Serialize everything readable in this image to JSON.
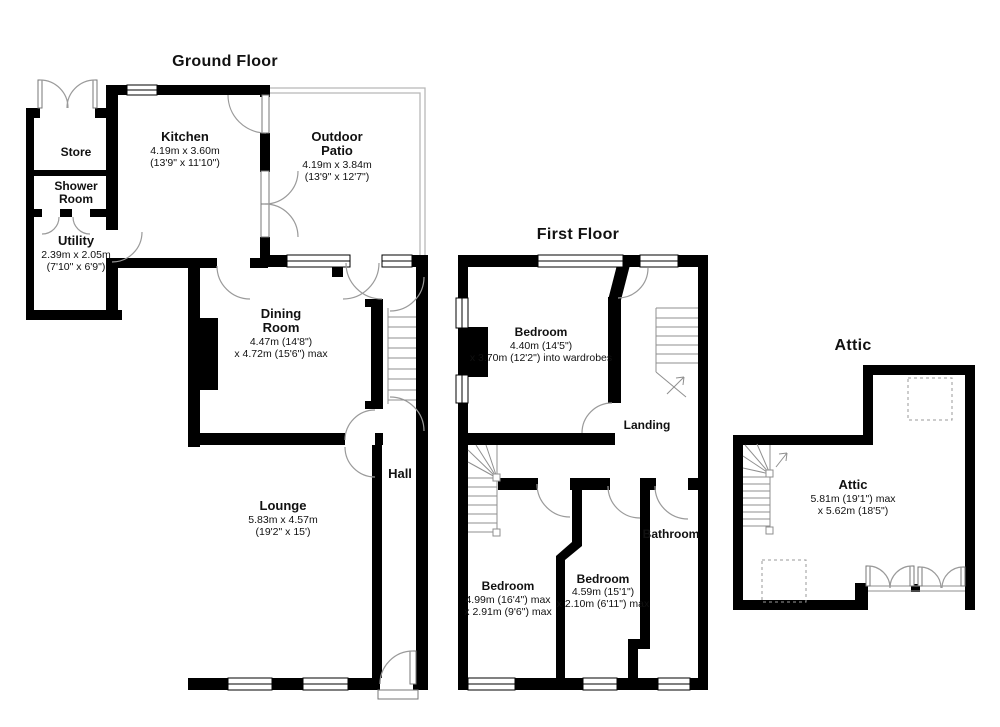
{
  "colors": {
    "background": "#ffffff",
    "wall": "#000000",
    "door_arc": "#9a9a9a",
    "patio_outline": "#b8b8b8",
    "text": "#111111"
  },
  "floors": {
    "ground": {
      "title": "Ground Floor",
      "rooms": {
        "store": {
          "name": "Store"
        },
        "shower_room": {
          "name_line1": "Shower",
          "name_line2": "Room"
        },
        "utility": {
          "name": "Utility",
          "dims_metric": "2.39m x 2.05m",
          "dims_imperial": "(7'10\" x 6'9\")"
        },
        "kitchen": {
          "name": "Kitchen",
          "dims_metric": "4.19m x 3.60m",
          "dims_imperial": "(13'9\" x 11'10\")"
        },
        "outdoor_patio": {
          "name_line1": "Outdoor",
          "name_line2": "Patio",
          "dims_metric": "4.19m x 3.84m",
          "dims_imperial": "(13'9\" x 12'7\")"
        },
        "dining_room": {
          "name_line1": "Dining",
          "name_line2": "Room",
          "dims_line1": "4.47m (14'8\")",
          "dims_line2": "x 4.72m (15'6\") max"
        },
        "lounge": {
          "name": "Lounge",
          "dims_metric": "5.83m x 4.57m",
          "dims_imperial": "(19'2\" x 15')"
        },
        "hall": {
          "name": "Hall"
        }
      }
    },
    "first": {
      "title": "First Floor",
      "rooms": {
        "bedroom_rear": {
          "name": "Bedroom",
          "dims_line1": "4.40m (14'5\")",
          "dims_line2": "x 3.70m (12'2\") into wardrobes"
        },
        "landing": {
          "name": "Landing"
        },
        "bedroom_front_left": {
          "name": "Bedroom",
          "dims_line1": "4.99m (16'4\") max",
          "dims_line2": "x 2.91m (9'6\") max"
        },
        "bedroom_front_middle": {
          "name": "Bedroom",
          "dims_line1": "4.59m (15'1\")",
          "dims_line2": "x 2.10m (6'11\") max"
        },
        "bathroom": {
          "name": "Bathroom"
        }
      }
    },
    "attic": {
      "title": "Attic",
      "rooms": {
        "attic": {
          "name": "Attic",
          "dims_line1": "5.81m (19'1\") max",
          "dims_line2": "x 5.62m (18'5\")"
        }
      }
    }
  }
}
